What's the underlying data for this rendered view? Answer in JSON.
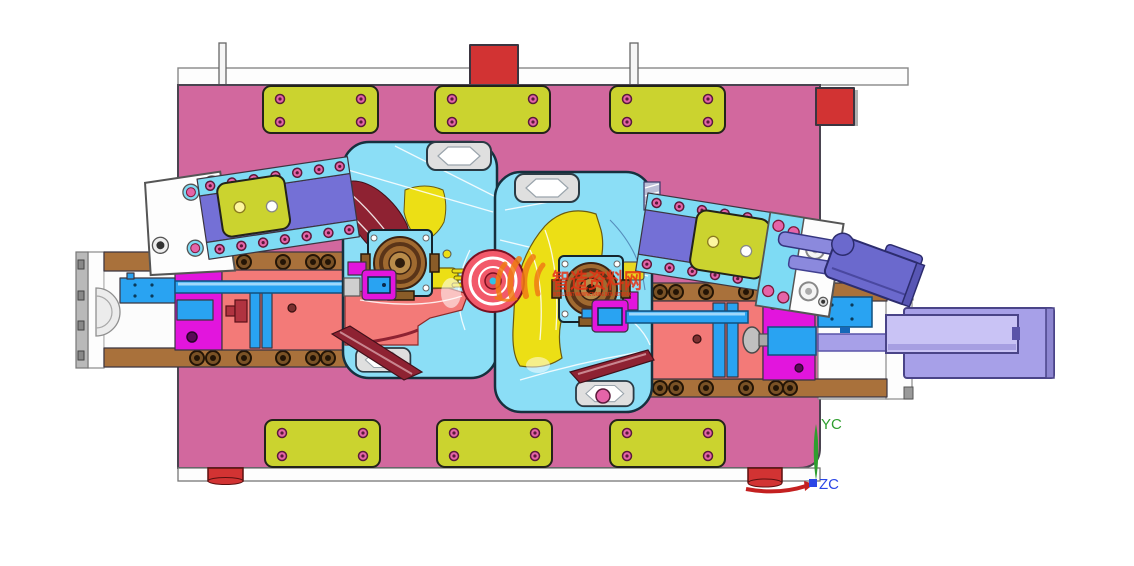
{
  "watermark": {
    "logo_icon": "flame-strokes-logo",
    "title": "智造资料网",
    "subtitle": "INTELLIGENT MANUFACTURING DATA NETWORK"
  },
  "axes": {
    "y_label": "YC",
    "z_label": "ZC"
  },
  "palette": {
    "plate": "#d2689e",
    "pad": "#cbd32f",
    "pad_hole": "#e564a8",
    "insert": "#8bdef6",
    "yellow_part": "#ecdf15",
    "salmon": "#f37a78",
    "ring": "#f2596a",
    "maroon": "#8e2232",
    "brown": "#a9713b",
    "bolt": "#6a4520",
    "blue": "#29a3f2",
    "magenta": "#e215dd",
    "purple_band": "#7470d6",
    "cyan_strip": "#7edbf4",
    "lavender": "#a7a0e8",
    "lavender_light": "#c9c3f5",
    "violet": "#6b69cd",
    "red_block": "#d23333",
    "wm_orange": "#f07c14",
    "wm_red": "#e63214",
    "axis_green": "#2f9e2f",
    "axis_blue": "#2b46e6",
    "axis_red": "#c42020"
  }
}
